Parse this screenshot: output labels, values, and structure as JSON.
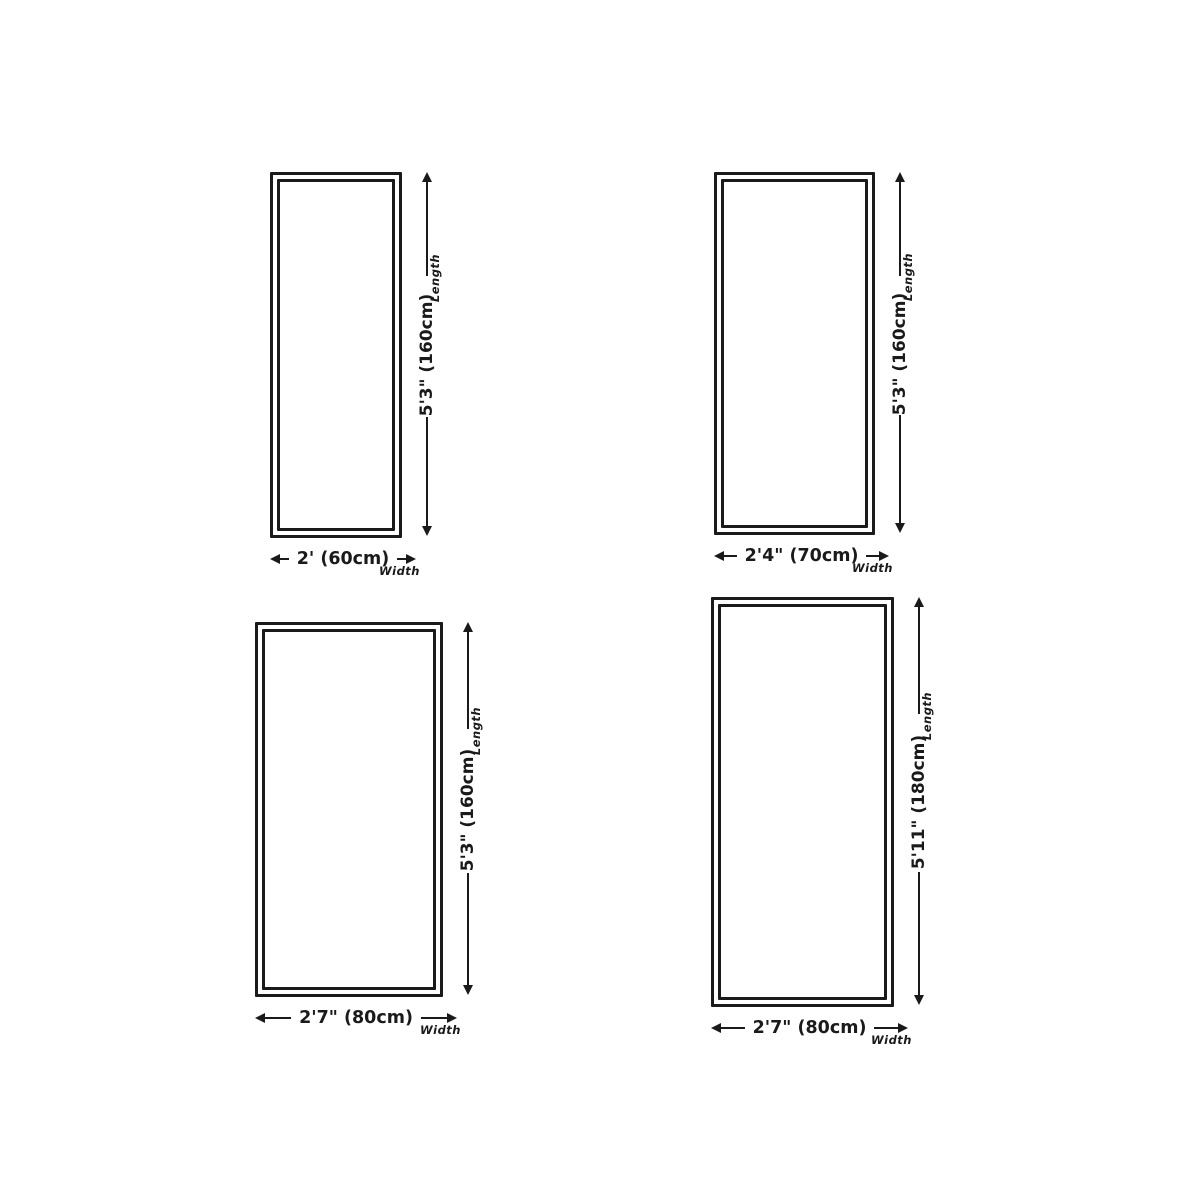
{
  "page": {
    "background": "#ffffff",
    "line_color": "#1a1a1a",
    "description": "Four rug size diagrams with length and width dimension arrows"
  },
  "diagrams": [
    {
      "position": "top-left",
      "length": "5'3\" (160cm)",
      "width": "2' (60cm)",
      "length_axis_label": "Length",
      "width_axis_label": "Width"
    },
    {
      "position": "top-right",
      "length": "5'3\" (160cm)",
      "width": "2'4\" (70cm)",
      "length_axis_label": "Length",
      "width_axis_label": "Width"
    },
    {
      "position": "bottom-left",
      "length": "5'3\" (160cm)",
      "width": "2'7\" (80cm)",
      "length_axis_label": "Length",
      "width_axis_label": "Width"
    },
    {
      "position": "bottom-right",
      "length": "5'11\" (180cm)",
      "width": "2'7\" (80cm)",
      "length_axis_label": "Length",
      "width_axis_label": "Width"
    }
  ]
}
